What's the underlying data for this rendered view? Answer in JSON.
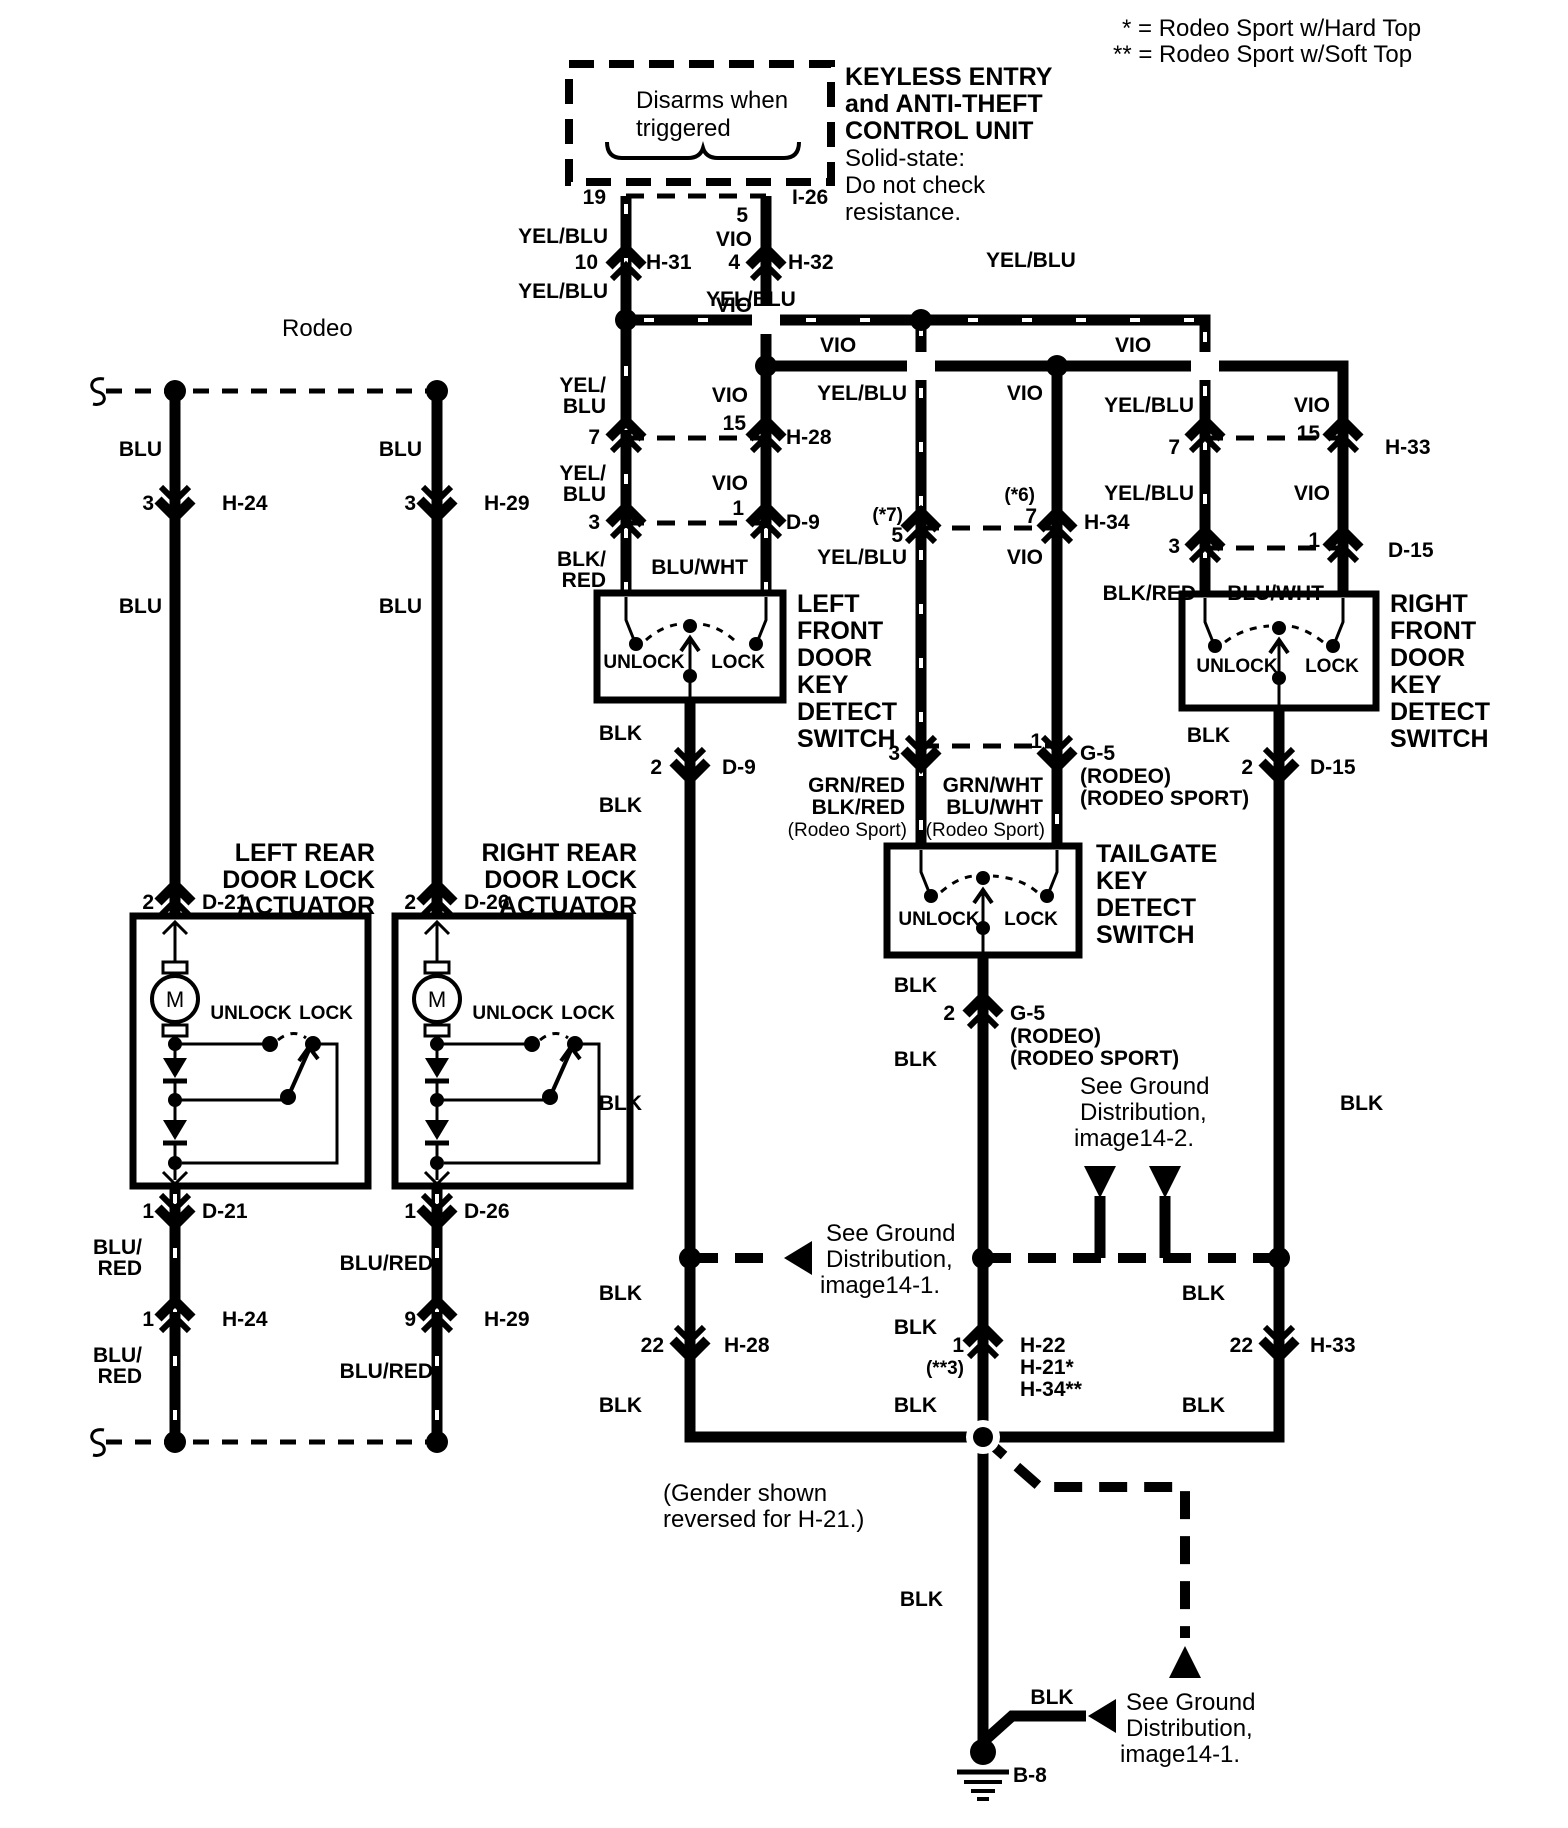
{
  "accent_color": "#000000",
  "background_color": "#ffffff",
  "legend": {
    "line1": "* =  Rodeo Sport w/Hard Top",
    "line2": "** =  Rodeo Sport  w/Soft Top"
  },
  "unit": {
    "disarms1": "Disarms when",
    "disarms2": "triggered",
    "title1": "KEYLESS ENTRY",
    "title2": "and ANTI-THEFT",
    "title3": "CONTROL UNIT",
    "note1": "Solid-state:",
    "note2": "Do not check",
    "note3": "resistance."
  },
  "colors": {
    "yelblu": "YEL/BLU",
    "vio": "VIO",
    "blu": "BLU",
    "blk": "BLK",
    "bluwht": "BLU/WHT",
    "blkred": "BLK/RED",
    "blured": "BLU/RED",
    "grnred": "GRN/RED",
    "grnwht": "GRN/WHT",
    "yel_": "YEL/",
    "blk_": "BLK/",
    "blu_": "BLU/",
    "red": "RED"
  },
  "pins": {
    "n1": "1",
    "n2": "2",
    "n3": "3",
    "n4": "4",
    "n5": "5",
    "n7": "7",
    "n9": "9",
    "n10": "10",
    "n15": "15",
    "n19": "19",
    "n22": "22"
  },
  "connectors": {
    "i26": "I-26",
    "h31": "H-31",
    "h32": "H-32",
    "h28": "H-28",
    "h33": "H-33",
    "h34": "H-34",
    "d9": "D-9",
    "d15": "D-15",
    "h24": "H-24",
    "h29": "H-29",
    "d21": "D-21",
    "d26": "D-26",
    "g5": "G-5",
    "h22": "H-22",
    "h21s": "H-21*",
    "h34ss": "H-34**",
    "b8": "B-8",
    "star7": "(*7)",
    "star6": "(*6)",
    "star3": "(**3)",
    "rodeo_cap": "(RODEO)",
    "rodeo_sport_cap": "(RODEO SPORT)",
    "rodeo_sport": "(Rodeo Sport)"
  },
  "titles": {
    "rodeo": "Rodeo",
    "left_rear": [
      "LEFT REAR",
      "DOOR LOCK",
      "ACTUATOR"
    ],
    "right_rear": [
      "RIGHT REAR",
      "DOOR LOCK",
      "ACTUATOR"
    ],
    "left_front": [
      "LEFT",
      "FRONT",
      "DOOR",
      "KEY",
      "DETECT",
      "SWITCH"
    ],
    "right_front": [
      "RIGHT",
      "FRONT",
      "DOOR",
      "KEY",
      "DETECT",
      "SWITCH"
    ],
    "tailgate": [
      "TAILGATE",
      "KEY",
      "DETECT",
      "SWITCH"
    ]
  },
  "switch": {
    "unlock": "UNLOCK",
    "lock": "LOCK",
    "motor": "M"
  },
  "notes": {
    "gender1": "(Gender shown",
    "gender2": "reversed for H-21.)",
    "see_ground": "See Ground",
    "distribution": "Distribution,",
    "img141": "image14-1.",
    "img142": "image14-2."
  }
}
